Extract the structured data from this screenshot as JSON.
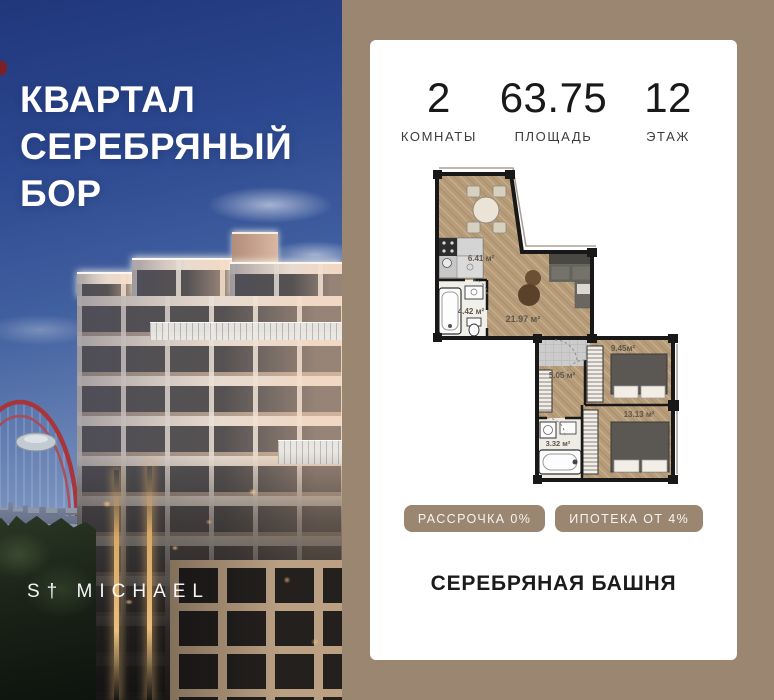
{
  "photo": {
    "headline_lines": [
      "КВАРТАЛ",
      "СЕРЕБРЯНЫЙ",
      "БОР"
    ],
    "brand": "S† MICHAEL"
  },
  "card": {
    "stats": [
      {
        "value": "2",
        "label": "КОМНАТЫ"
      },
      {
        "value": "63.75",
        "label": "ПЛОЩАДЬ"
      },
      {
        "value": "12",
        "label": "ЭТАЖ"
      }
    ],
    "floor_plan": {
      "rooms": [
        {
          "name": "kitchen",
          "area_label": "6.41 м²"
        },
        {
          "name": "bathroom-1",
          "area_label": "4.42 м²"
        },
        {
          "name": "living-room",
          "area_label": "21.97 м²"
        },
        {
          "name": "hallway",
          "area_label": "5.05 м²"
        },
        {
          "name": "bedroom-1",
          "area_label": "9.45м²"
        },
        {
          "name": "bedroom-2",
          "area_label": "13.13 м²"
        },
        {
          "name": "bathroom-2",
          "area_label": "3.32 м²"
        }
      ]
    },
    "badges": [
      {
        "label": "РАССРОЧКА 0%"
      },
      {
        "label": "ИПОТЕКА ОТ 4%"
      }
    ],
    "project_name": "СЕРЕБРЯНАЯ БАШНЯ"
  },
  "colors": {
    "accent_taupe": "#9b8672",
    "card_bg": "#ffffff",
    "text_dark": "#1b1b1b",
    "plan_wall": "#181818",
    "plan_floor": "#b79c7a",
    "bridge_red": "#a8353a",
    "sky_top": "#20377b"
  }
}
